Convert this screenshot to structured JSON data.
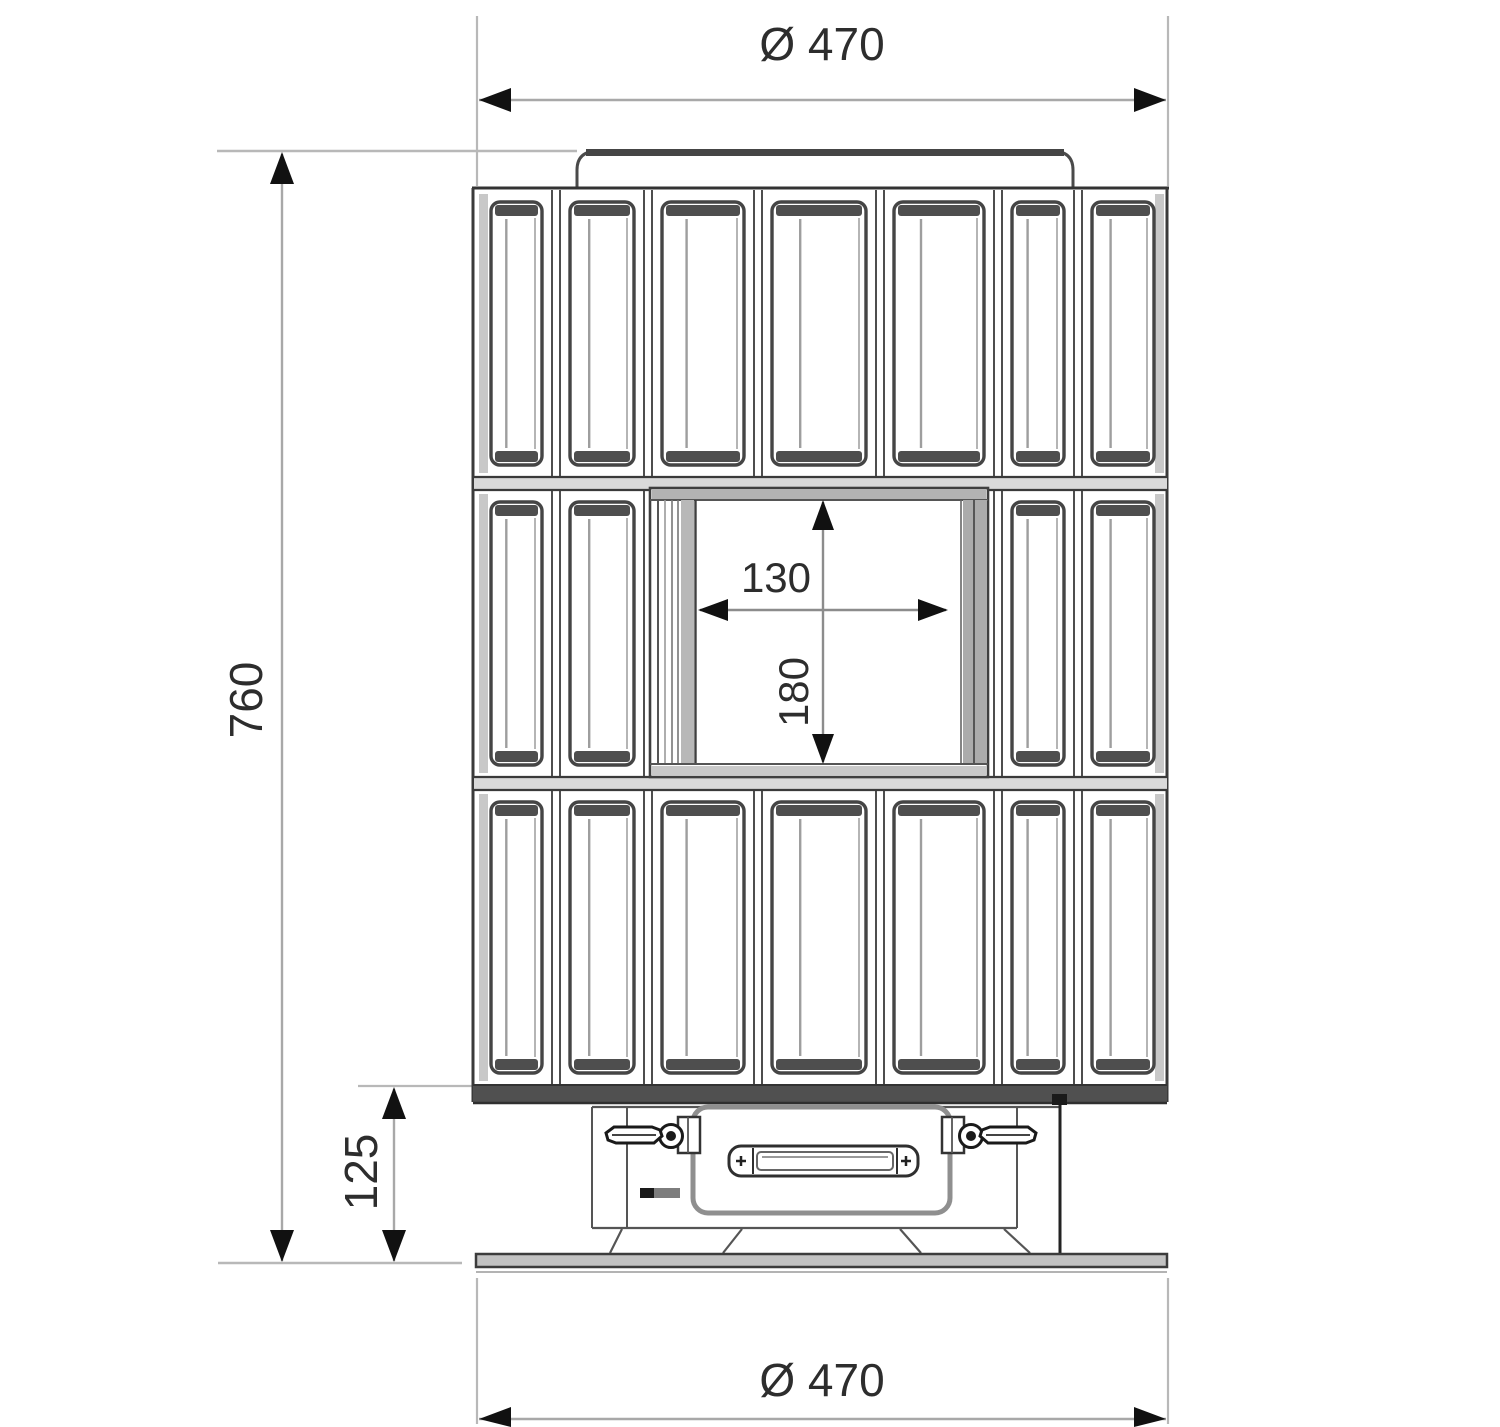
{
  "dimensions": {
    "top_diameter": "Ø 470",
    "overall_height": "760",
    "opening_width": "130",
    "opening_height": "180",
    "base_height": "125",
    "bottom_diameter": "Ø 470"
  }
}
